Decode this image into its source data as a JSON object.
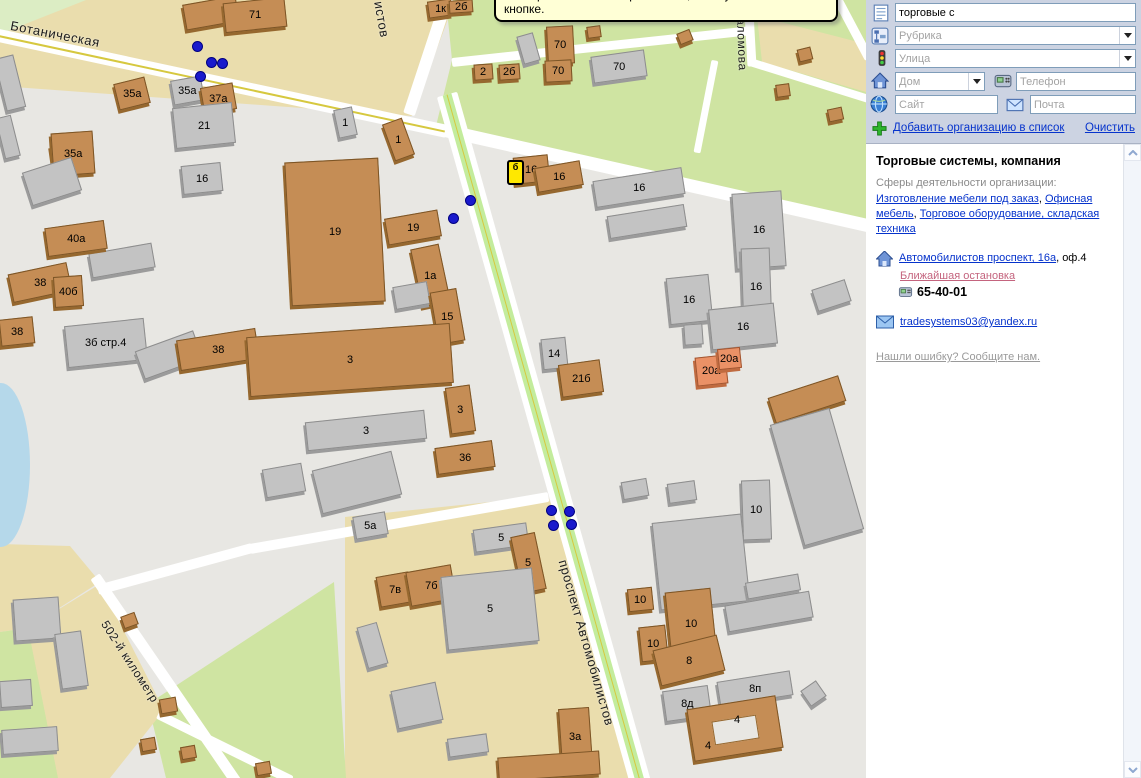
{
  "tooltip": "мастер обновления справочника, кликнув мышью по этой кнопке.",
  "sidebar": {
    "search_value": "торговые с",
    "rubric_placeholder": "Рубрика",
    "street_placeholder": "Улица",
    "house_placeholder": "Дом",
    "phone_placeholder": "Телефон",
    "site_placeholder": "Сайт",
    "mail_placeholder": "Почта",
    "add_org_link": "Добавить организацию в список",
    "clear_link": "Очистить",
    "org": {
      "title": "Торговые системы, компания",
      "spheres_label": "Сферы деятельности организации:",
      "sphere_links": [
        "Изготовление мебели под заказ",
        "Офисная мебель",
        "Торговое оборудование, складская техника"
      ],
      "comma": ",  ",
      "address_link": "Автомобилистов проспект, 16а",
      "address_office": ", оф.4",
      "nearest_stop_link": "Ближайшая остановка",
      "phone_number": "65-40-01",
      "email": "tradesystems03@yandex.ru",
      "report_error_link": "Нашли ошибку? Сообщите нам."
    }
  },
  "map": {
    "colors": {
      "bg": "#e8e7e3",
      "road": "#ffffff",
      "centerline": "#d6c83f",
      "avenue_stripe": "#c3ec9d",
      "dot": "#1a1acc",
      "marker": "#ffe800"
    },
    "street_labels": [
      {
        "text": "Ботаническая",
        "x": 12,
        "y": 18,
        "rot": 11,
        "size": 13
      },
      {
        "text": "истов",
        "x": 386,
        "y": 0,
        "rot": 80,
        "size": 13
      },
      {
        "text": "аломова",
        "x": 748,
        "y": 18,
        "rot": 88,
        "size": 12
      },
      {
        "text": "проспект Автомобилистов",
        "x": 570,
        "y": 558,
        "rot": 74,
        "size": 13
      },
      {
        "text": "502-й километр",
        "x": 110,
        "y": 618,
        "rot": 57,
        "size": 12
      }
    ],
    "zones": [
      {
        "color": "#dcedc4",
        "pts": [
          [
            0,
            0
          ],
          [
            98,
            0
          ],
          [
            0,
            40
          ]
        ]
      },
      {
        "color": "#eaddad",
        "pts": [
          [
            86,
            0
          ],
          [
            455,
            0
          ],
          [
            412,
            116
          ],
          [
            0,
            86
          ],
          [
            0,
            34
          ]
        ]
      },
      {
        "color": "#cfe4a2",
        "pts": [
          [
            446,
            0
          ],
          [
            866,
            0
          ],
          [
            866,
            220
          ],
          [
            436,
            126
          ],
          [
            452,
            60
          ]
        ]
      },
      {
        "color": "#eaddad",
        "pts": [
          [
            757,
            16
          ],
          [
            866,
            44
          ],
          [
            866,
            92
          ],
          [
            762,
            62
          ]
        ]
      },
      {
        "color": "#eaddad",
        "pts": [
          [
            345,
            517
          ],
          [
            548,
            496
          ],
          [
            650,
            778
          ],
          [
            345,
            778
          ]
        ]
      },
      {
        "color": "#cfe4a2",
        "pts": [
          [
            148,
            704
          ],
          [
            334,
            582
          ],
          [
            346,
            778
          ],
          [
            166,
            778
          ]
        ]
      },
      {
        "color": "#eaddad",
        "pts": [
          [
            0,
            544
          ],
          [
            70,
            546
          ],
          [
            100,
            582
          ],
          [
            28,
            628
          ],
          [
            0,
            632
          ]
        ]
      },
      {
        "color": "#cfe4a2",
        "pts": [
          [
            0,
            632
          ],
          [
            28,
            628
          ],
          [
            68,
            778
          ],
          [
            0,
            778
          ]
        ]
      },
      {
        "color": "#eaddad",
        "pts": [
          [
            28,
            628
          ],
          [
            100,
            584
          ],
          [
            164,
            710
          ],
          [
            110,
            778
          ],
          [
            58,
            778
          ]
        ]
      }
    ],
    "water": {
      "x": -28,
      "y": 383,
      "w": 58,
      "h": 164
    },
    "roads": [
      {
        "x1": -6,
        "y1": 34,
        "x2": 447,
        "y2": 131,
        "w": 13,
        "kind": "yellow"
      },
      {
        "x1": 445,
        "y1": 130,
        "x2": 872,
        "y2": 226,
        "w": 13,
        "kind": "plain"
      },
      {
        "x1": 450,
        "y1": -10,
        "x2": 409,
        "y2": 114,
        "w": 12,
        "kind": "plain"
      },
      {
        "x1": 447,
        "y1": 94,
        "x2": 641,
        "y2": 784,
        "w": 21,
        "kind": "avenue"
      },
      {
        "x1": 95,
        "y1": 576,
        "x2": 238,
        "y2": 784,
        "w": 11,
        "kind": "plain"
      },
      {
        "x1": 158,
        "y1": 714,
        "x2": 292,
        "y2": 780,
        "w": 9,
        "kind": "plain"
      },
      {
        "x1": 98,
        "y1": 590,
        "x2": 252,
        "y2": 548,
        "w": 10,
        "kind": "plain"
      },
      {
        "x1": 250,
        "y1": 549,
        "x2": 548,
        "y2": 497,
        "w": 10,
        "kind": "plain"
      },
      {
        "x1": 452,
        "y1": 62,
        "x2": 752,
        "y2": 30,
        "w": 9,
        "kind": "plain"
      },
      {
        "x1": 748,
        "y1": -6,
        "x2": 752,
        "y2": 66,
        "w": 9,
        "kind": "plain"
      },
      {
        "x1": 750,
        "y1": 62,
        "x2": 872,
        "y2": 100,
        "w": 8,
        "kind": "plain"
      },
      {
        "x1": 715,
        "y1": 60,
        "x2": 697,
        "y2": 152,
        "w": 7,
        "kind": "plain"
      },
      {
        "x1": 834,
        "y1": -8,
        "x2": 869,
        "y2": 58,
        "w": 9,
        "kind": "plain"
      }
    ],
    "buildings": [
      [
        184,
        0,
        54,
        26,
        -10,
        "b",
        ""
      ],
      [
        224,
        0,
        62,
        30,
        -6,
        "b",
        "71"
      ],
      [
        428,
        0,
        24,
        17,
        -8,
        "b",
        "1к"
      ],
      [
        449,
        0,
        24,
        13,
        -4,
        "b",
        "2б"
      ],
      [
        474,
        64,
        19,
        16,
        -4,
        "b",
        "2"
      ],
      [
        499,
        64,
        21,
        16,
        -4,
        "b",
        "2б"
      ],
      [
        547,
        26,
        27,
        38,
        -3,
        "b",
        "70"
      ],
      [
        545,
        60,
        27,
        22,
        -3,
        "b",
        "70"
      ],
      [
        592,
        53,
        54,
        27,
        -8,
        "g",
        "70"
      ],
      [
        520,
        34,
        17,
        29,
        -16,
        "g",
        ""
      ],
      [
        587,
        26,
        14,
        12,
        -8,
        "b",
        ""
      ],
      [
        678,
        31,
        14,
        12,
        -22,
        "b",
        ""
      ],
      [
        727,
        0,
        14,
        11,
        -8,
        "b",
        ""
      ],
      [
        798,
        48,
        14,
        13,
        -14,
        "b",
        ""
      ],
      [
        776,
        84,
        14,
        13,
        -8,
        "b",
        ""
      ],
      [
        828,
        108,
        15,
        13,
        -12,
        "b",
        ""
      ],
      [
        0,
        56,
        20,
        54,
        -14,
        "g",
        ""
      ],
      [
        0,
        116,
        16,
        42,
        -14,
        "g",
        ""
      ],
      [
        52,
        144,
        15,
        33,
        -8,
        "b",
        ""
      ],
      [
        116,
        80,
        32,
        27,
        -14,
        "b",
        "35а"
      ],
      [
        172,
        78,
        31,
        25,
        -10,
        "g",
        "35а"
      ],
      [
        202,
        85,
        33,
        27,
        -10,
        "b",
        "37а"
      ],
      [
        174,
        105,
        60,
        41,
        -6,
        "g",
        "21"
      ],
      [
        52,
        132,
        42,
        43,
        -4,
        "b",
        "35а"
      ],
      [
        26,
        164,
        52,
        35,
        -18,
        "g",
        ""
      ],
      [
        182,
        164,
        40,
        29,
        -6,
        "g",
        "16"
      ],
      [
        90,
        248,
        64,
        25,
        -10,
        "g",
        ""
      ],
      [
        46,
        224,
        60,
        29,
        -8,
        "b",
        "40а"
      ],
      [
        10,
        268,
        60,
        29,
        -12,
        "b",
        "38"
      ],
      [
        54,
        276,
        29,
        31,
        -4,
        "b",
        "40б"
      ],
      [
        0,
        318,
        34,
        27,
        -6,
        "b",
        "38"
      ],
      [
        66,
        322,
        80,
        42,
        -6,
        "g",
        "3б стр.4"
      ],
      [
        138,
        340,
        62,
        30,
        -20,
        "g",
        ""
      ],
      [
        178,
        334,
        80,
        31,
        -9,
        "b",
        "38"
      ],
      [
        336,
        108,
        19,
        29,
        -12,
        "g",
        "1"
      ],
      [
        388,
        120,
        21,
        39,
        -20,
        "b",
        "1"
      ],
      [
        288,
        160,
        94,
        144,
        -3,
        "b",
        "19"
      ],
      [
        386,
        214,
        54,
        27,
        -10,
        "b",
        "19"
      ],
      [
        416,
        246,
        29,
        59,
        -12,
        "b",
        "1а"
      ],
      [
        394,
        284,
        35,
        23,
        -10,
        "g",
        ""
      ],
      [
        434,
        290,
        27,
        53,
        -10,
        "b",
        "15"
      ],
      [
        248,
        330,
        204,
        60,
        -4,
        "b",
        "3"
      ],
      [
        448,
        386,
        25,
        47,
        -8,
        "b",
        "3"
      ],
      [
        306,
        416,
        120,
        29,
        -6,
        "g",
        "3"
      ],
      [
        436,
        444,
        58,
        27,
        -8,
        "b",
        "36"
      ],
      [
        316,
        460,
        82,
        45,
        -14,
        "g",
        ""
      ],
      [
        264,
        466,
        40,
        29,
        -10,
        "g",
        ""
      ],
      [
        542,
        338,
        25,
        31,
        -6,
        "g",
        "14"
      ],
      [
        560,
        362,
        42,
        33,
        -8,
        "b",
        "21б"
      ],
      [
        514,
        156,
        35,
        27,
        -6,
        "b",
        "16"
      ],
      [
        536,
        164,
        46,
        25,
        -10,
        "b",
        "16"
      ],
      [
        594,
        174,
        90,
        27,
        -9,
        "g",
        "16"
      ],
      [
        608,
        210,
        78,
        23,
        -9,
        "g",
        ""
      ],
      [
        734,
        192,
        50,
        76,
        -4,
        "g",
        "16"
      ],
      [
        742,
        248,
        29,
        78,
        -2,
        "g",
        "16"
      ],
      [
        668,
        276,
        43,
        47,
        -6,
        "g",
        "16"
      ],
      [
        710,
        306,
        66,
        41,
        -6,
        "g",
        "16"
      ],
      [
        684,
        324,
        19,
        21,
        -4,
        "g",
        ""
      ],
      [
        814,
        284,
        35,
        23,
        -18,
        "g",
        ""
      ],
      [
        696,
        356,
        31,
        29,
        -6,
        "s",
        "20а"
      ],
      [
        718,
        348,
        23,
        21,
        -6,
        "s",
        "20а"
      ],
      [
        770,
        386,
        74,
        27,
        -18,
        "b",
        ""
      ],
      [
        786,
        414,
        62,
        126,
        -16,
        "g",
        ""
      ],
      [
        742,
        480,
        29,
        60,
        -2,
        "g",
        "10"
      ],
      [
        622,
        480,
        26,
        18,
        -10,
        "g",
        ""
      ],
      [
        668,
        482,
        28,
        20,
        -8,
        "g",
        ""
      ],
      [
        656,
        518,
        90,
        88,
        -6,
        "g",
        ""
      ],
      [
        746,
        578,
        54,
        17,
        -10,
        "g",
        ""
      ],
      [
        726,
        598,
        86,
        27,
        -10,
        "g",
        ""
      ],
      [
        354,
        514,
        33,
        23,
        -10,
        "g",
        "5а"
      ],
      [
        474,
        526,
        54,
        23,
        -8,
        "g",
        "5"
      ],
      [
        516,
        534,
        25,
        58,
        -12,
        "b",
        "5"
      ],
      [
        378,
        574,
        33,
        31,
        -10,
        "b",
        "7в"
      ],
      [
        408,
        568,
        46,
        35,
        -10,
        "b",
        "7б"
      ],
      [
        444,
        572,
        92,
        74,
        -6,
        "g",
        "5"
      ],
      [
        362,
        624,
        21,
        43,
        -16,
        "g",
        ""
      ],
      [
        394,
        686,
        46,
        39,
        -12,
        "g",
        ""
      ],
      [
        448,
        736,
        40,
        19,
        -8,
        "g",
        ""
      ],
      [
        560,
        708,
        31,
        57,
        -4,
        "b",
        "3а"
      ],
      [
        498,
        754,
        102,
        24,
        -4,
        "b",
        ""
      ],
      [
        628,
        588,
        25,
        23,
        -6,
        "b",
        "10"
      ],
      [
        668,
        590,
        46,
        67,
        -6,
        "b",
        "10"
      ],
      [
        640,
        626,
        27,
        35,
        -6,
        "b",
        "10"
      ],
      [
        656,
        642,
        66,
        37,
        -14,
        "b",
        "8"
      ],
      [
        664,
        688,
        46,
        31,
        -8,
        "g",
        "8д"
      ],
      [
        718,
        676,
        74,
        25,
        -9,
        "g",
        "8п"
      ],
      [
        804,
        684,
        19,
        19,
        -35,
        "g",
        ""
      ],
      [
        690,
        702,
        90,
        53,
        -9,
        "b",
        ""
      ],
      [
        713,
        718,
        45,
        24,
        -9,
        "h",
        ""
      ],
      [
        731,
        714,
        12,
        12,
        0,
        "t",
        "4"
      ],
      [
        702,
        740,
        12,
        12,
        0,
        "t",
        "4"
      ],
      [
        14,
        598,
        46,
        42,
        -4,
        "g",
        ""
      ],
      [
        58,
        632,
        27,
        56,
        -8,
        "g",
        ""
      ],
      [
        0,
        680,
        32,
        27,
        -4,
        "g",
        ""
      ],
      [
        2,
        728,
        56,
        25,
        -4,
        "g",
        ""
      ],
      [
        122,
        614,
        15,
        13,
        -20,
        "b",
        ""
      ],
      [
        160,
        698,
        17,
        15,
        -10,
        "b",
        ""
      ],
      [
        141,
        738,
        15,
        13,
        -10,
        "b",
        ""
      ],
      [
        181,
        746,
        15,
        13,
        -10,
        "b",
        ""
      ],
      [
        256,
        762,
        15,
        13,
        -10,
        "b",
        ""
      ]
    ],
    "dots": [
      [
        197,
        46
      ],
      [
        211,
        62
      ],
      [
        222,
        63
      ],
      [
        200,
        76
      ],
      [
        470,
        200
      ],
      [
        453,
        218
      ],
      [
        551,
        510
      ],
      [
        569,
        511
      ],
      [
        553,
        525
      ],
      [
        571,
        524
      ]
    ],
    "marker": {
      "x": 507,
      "y": 160,
      "w": 17,
      "h": 25,
      "label": "б"
    }
  }
}
